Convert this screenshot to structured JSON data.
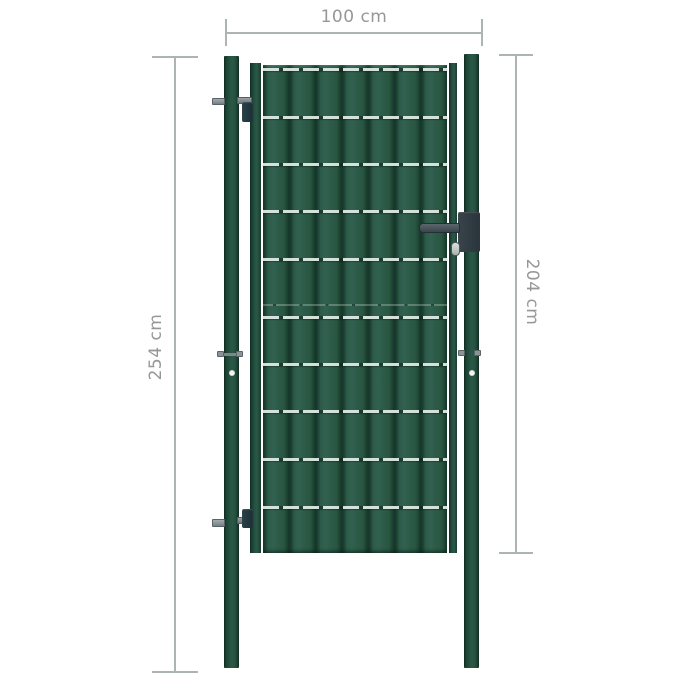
{
  "annotations": {
    "width_label": "100 cm",
    "gate_height_label": "204 cm",
    "post_height_label": "254 cm"
  },
  "colors": {
    "background": "#ffffff",
    "panel_green": "#2d5b4a",
    "slat_ridge": "#16352a",
    "post_green": "#27543f",
    "wire_light": "#dde9e4",
    "hardware_gray": "#8b9397",
    "lock_dark": "#39444b",
    "dim_line": "#adb4b4",
    "dim_text": "#979797"
  },
  "components": [
    "left-post",
    "right-post",
    "gate-frame",
    "pvc-slat-panel",
    "mesh-wires",
    "top-hinge",
    "bottom-hinge",
    "mounting-bolts",
    "lock-with-handle",
    "key-cylinder"
  ]
}
